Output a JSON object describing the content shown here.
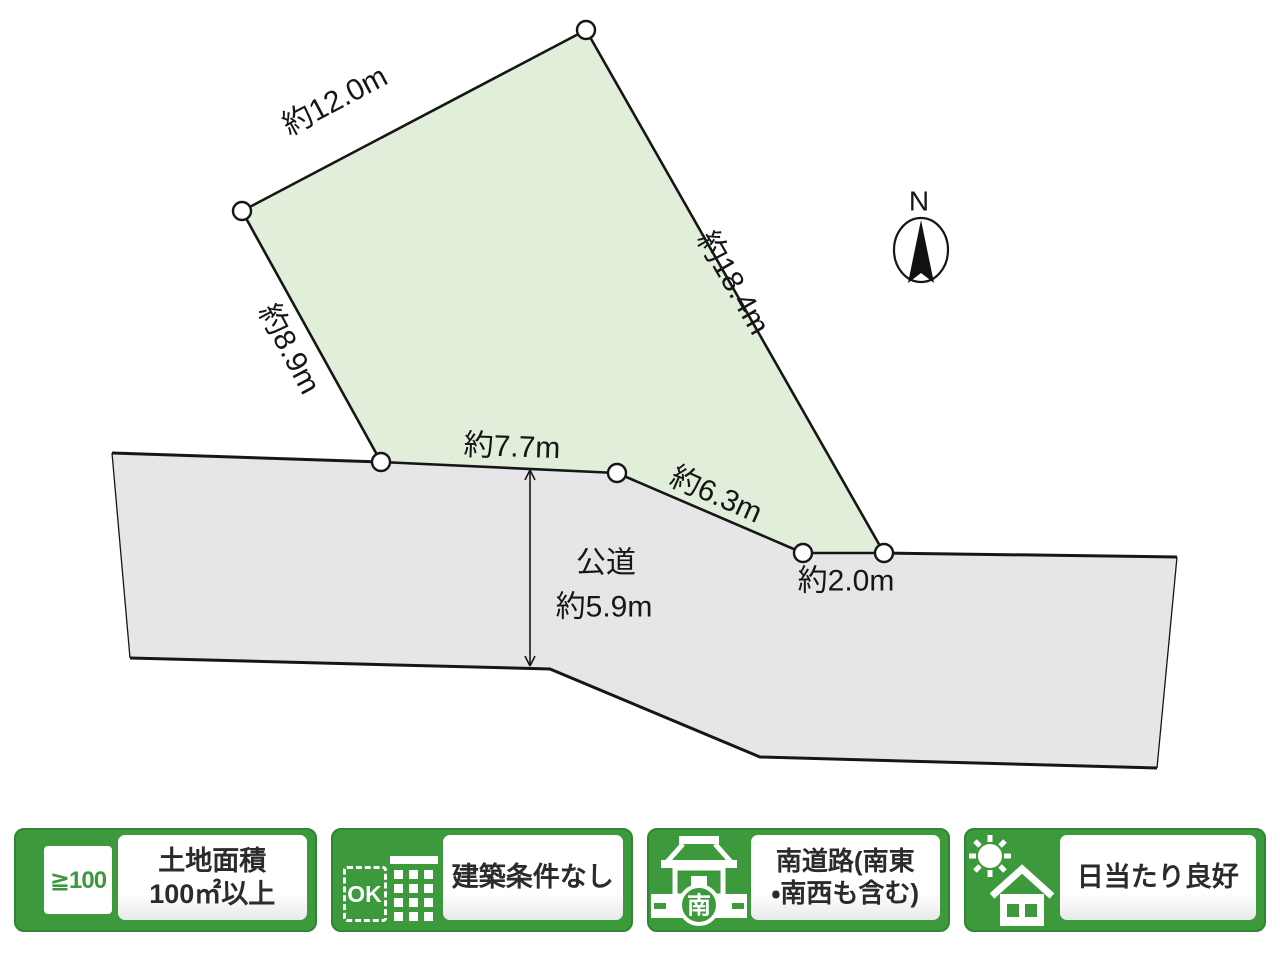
{
  "colors": {
    "badge_green": "#3c9a3c",
    "badge_green_dark": "#2f8532",
    "plot_fill": "#e1efda",
    "road_fill": "#e6e5e7",
    "line": "#161616",
    "panel_text": "#2b2b2b"
  },
  "diagram": {
    "compass_label": "N",
    "edge_labels": {
      "north_west": "約12.0m",
      "north_east": "約18.4m",
      "west": "約8.9m",
      "south_left": "約7.7m",
      "south_slope": "約6.3m",
      "south_short": "約2.0m"
    },
    "road_label_line1": "公道",
    "road_label_line2": "約5.9m"
  },
  "badges": [
    {
      "id": "land-area",
      "icon_text": "≧100",
      "lines": [
        "土地面積",
        "100㎡以上"
      ]
    },
    {
      "id": "no-build-conditions",
      "icon_text": "OK",
      "lines": [
        "建築条件なし"
      ]
    },
    {
      "id": "south-road",
      "icon_text": "南",
      "lines": [
        "南道路(南東",
        "・南西も含む)"
      ]
    },
    {
      "id": "good-sunlight",
      "icon_text": "",
      "lines": [
        "日当たり良好"
      ]
    }
  ]
}
